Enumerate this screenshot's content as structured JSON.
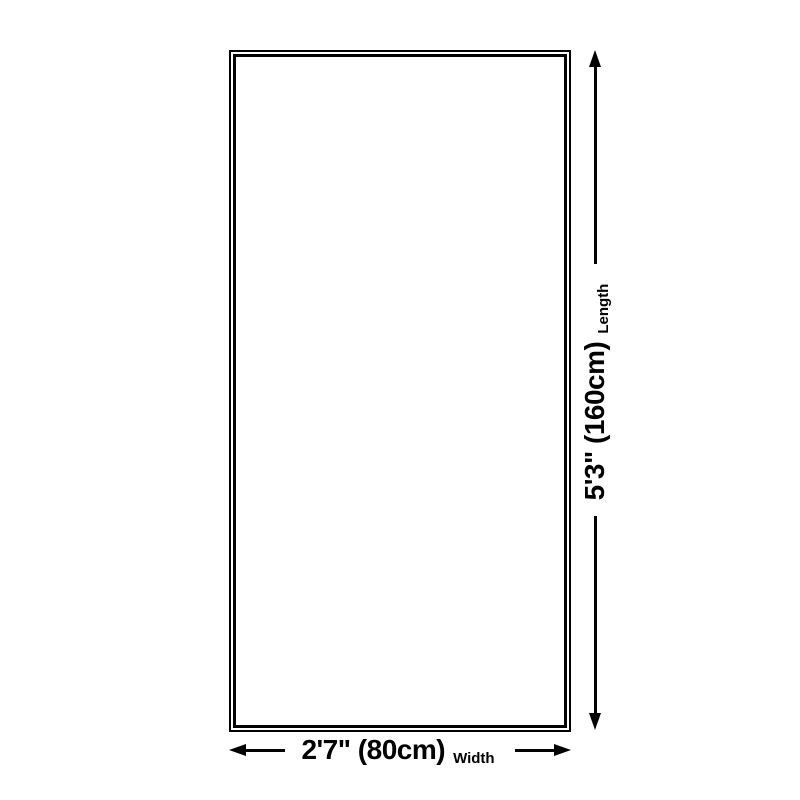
{
  "diagram": {
    "background_color": "#ffffff",
    "line_color": "#000000",
    "shape": "rectangle-outline-double-border",
    "dimensions": {
      "width": {
        "value": "2'7\" (80cm)",
        "label": "Width"
      },
      "length": {
        "value": "5'3\" (160cm)",
        "label": "Length"
      }
    }
  }
}
